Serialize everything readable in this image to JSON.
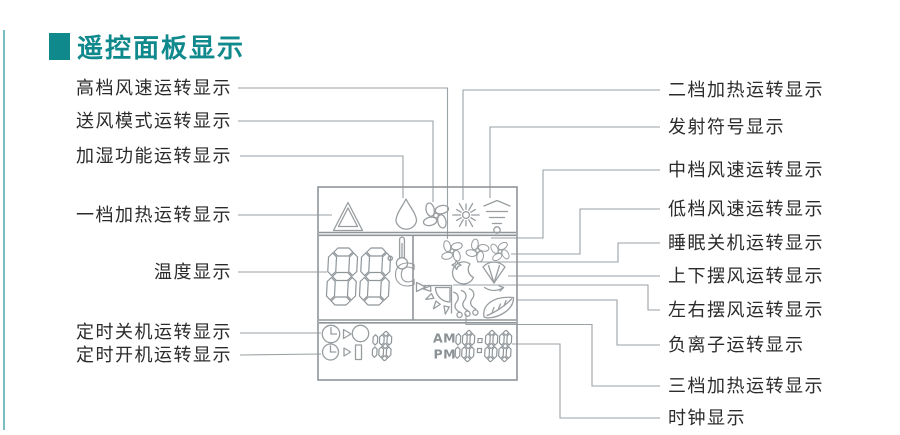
{
  "title": {
    "text": "遥控面板显示"
  },
  "colors": {
    "accent": "#10898d",
    "line_art": "#989da0",
    "label_text": "#2b2b2b",
    "background": "#ffffff"
  },
  "labels": {
    "left": [
      "高档风速运转显示",
      "送风模式运转显示",
      "加湿功能运转显示",
      "一档加热运转显示",
      "温度显示",
      "定时关机运转显示",
      "定时开机运转显示"
    ],
    "right": [
      "二档加热运转显示",
      "发射符号显示",
      "中档风速运转显示",
      "低档风速运转显示",
      "睡眠关机运转显示",
      "上下摆风运转显示",
      "左右摆风运转显示",
      "负离子运转显示",
      "三档加热运转显示",
      "时钟显示"
    ]
  },
  "panel": {
    "temperature": {
      "value": "88",
      "unit_degree": "°",
      "unit_letter": "C"
    },
    "clock": {
      "am": "AM",
      "pm": "PM",
      "value": "18:88"
    },
    "timer": {
      "value": "18"
    },
    "icons": [
      {
        "name": "heat-level1-icon",
        "meaning": "一档加热"
      },
      {
        "name": "humidify-icon",
        "meaning": "加湿功能"
      },
      {
        "name": "fan-mode-icon",
        "meaning": "送风模式"
      },
      {
        "name": "heat-level2-icon",
        "meaning": "二档加热"
      },
      {
        "name": "transmit-icon",
        "meaning": "发射符号"
      },
      {
        "name": "wind-high-icon",
        "meaning": "高档风速"
      },
      {
        "name": "wind-mid-icon",
        "meaning": "中档风速"
      },
      {
        "name": "wind-low-icon",
        "meaning": "低档风速"
      },
      {
        "name": "sleep-icon",
        "meaning": "睡眠关机"
      },
      {
        "name": "swing-updown-icon",
        "meaning": "上下摆风"
      },
      {
        "name": "swing-leftright-icon",
        "meaning": "左右摆风"
      },
      {
        "name": "heat-level3-icon",
        "meaning": "三档加热"
      },
      {
        "name": "anion-icon",
        "meaning": "负离子"
      },
      {
        "name": "timer-off-icon",
        "meaning": "定时关机"
      },
      {
        "name": "timer-on-icon",
        "meaning": "定时开机"
      },
      {
        "name": "thermometer-icon",
        "meaning": "温度"
      }
    ]
  }
}
